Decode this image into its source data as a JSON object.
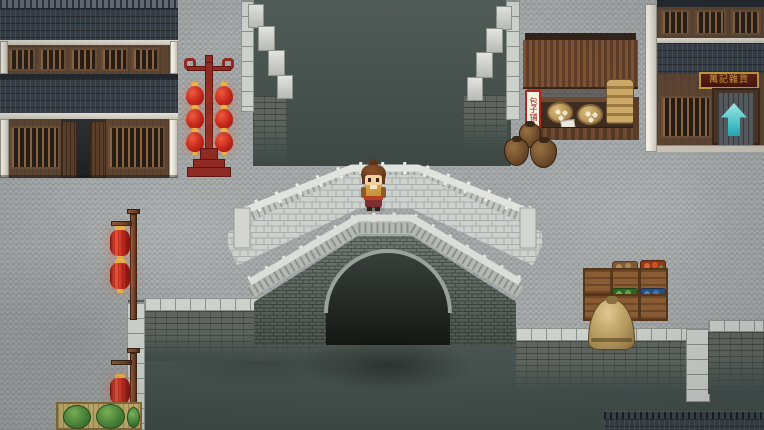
{
  "viewport": {
    "width": 764,
    "height": 430,
    "kind": "top-down-rpg-town-canal-scene"
  },
  "texts": {
    "stall_banner": "包子铺",
    "shop_plaque": "萬記雜貨"
  },
  "icons": {
    "transfer_arrow": "up-arrow"
  },
  "palette": {
    "street": "#a4a8a8",
    "water": "#47524e",
    "roof_tile": "#363d45",
    "wood_wall": "#5c4431",
    "lattice": "#8a6446",
    "white_trim": "#e6e1d6",
    "stone_coping": "#cdd1cc",
    "embankment_brick": "#5f655e",
    "lantern_red": "#c3261b",
    "lantern_gold": "#e7b243",
    "rack_red": "#8f2b22",
    "awning_brown": "#6e4a31",
    "plaque_board": "#5e2014",
    "plaque_gold": "#d9a43c",
    "arrow_cyan": "#43c6cd",
    "cabbage_green": "#4e8c39",
    "sack_tan": "#b79a5e",
    "crate_wood": "#8a5c33",
    "character_hair": "#74421f",
    "character_robe": "#d8a449",
    "character_belt": "#b5401f",
    "character_skirt": "#7e2f33",
    "character_skin": "#f3cfa2"
  },
  "objects": {
    "buildings": [
      "two-story-timber-inn",
      "general-store"
    ],
    "props": [
      "stone-arch-bridge",
      "canal-water",
      "red-lantern-rack",
      "bun-stall",
      "clay-jars",
      "steamer-basket-stack",
      "bun-baskets",
      "lantern-pole-upper",
      "lantern-pole-lower",
      "goods-crates",
      "grain-sack",
      "vegetable-mat",
      "transfer-arrow",
      "player-character"
    ]
  }
}
